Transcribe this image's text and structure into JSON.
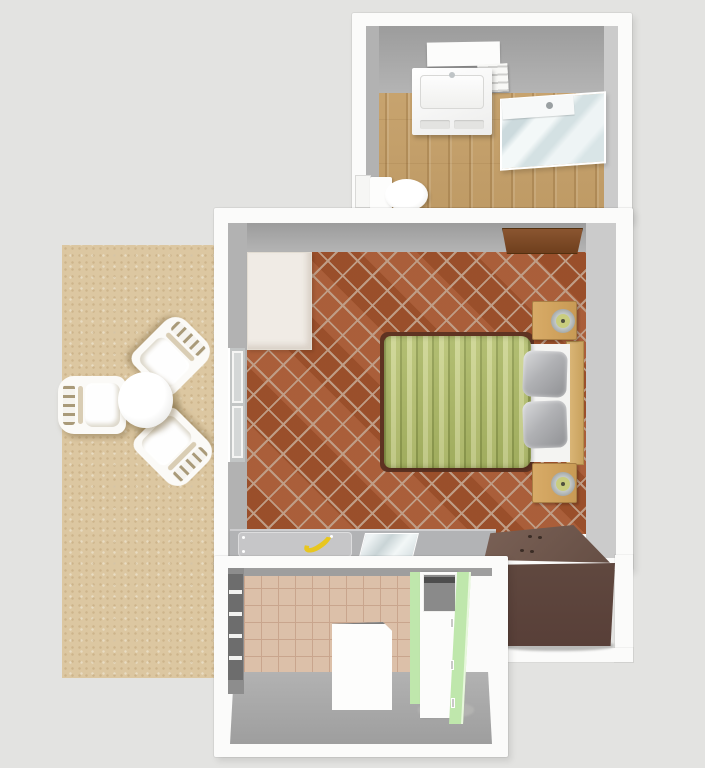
{
  "scene": {
    "view": "top-down 3D dollhouse render of a small apartment",
    "rooms": [
      {
        "id": "bathroom",
        "label": "Bathroom",
        "floor": "light wood planks"
      },
      {
        "id": "bedroom",
        "label": "Bedroom",
        "floor": "terracotta diamond tiles"
      },
      {
        "id": "kitchen",
        "label": "Kitchen",
        "floor": "beige ceramic tiles"
      },
      {
        "id": "patio",
        "label": "Patio",
        "floor": "sand"
      }
    ],
    "furniture": [
      {
        "room": "bathroom",
        "id": "mirror-shelf",
        "label": "Wall mirror shelf"
      },
      {
        "room": "bathroom",
        "id": "vanity-sink",
        "label": "Sink cabinet"
      },
      {
        "room": "bathroom",
        "id": "side-shelf",
        "label": "Towel shelf"
      },
      {
        "room": "bathroom",
        "id": "shower-cabin",
        "label": "Glass corner shower"
      },
      {
        "room": "bathroom",
        "id": "toilet",
        "label": "Toilet"
      },
      {
        "room": "bathroom",
        "id": "door-panel",
        "label": "Bathroom door"
      },
      {
        "room": "bedroom",
        "id": "entry-door",
        "label": "Open wooden door"
      },
      {
        "room": "bedroom",
        "id": "rug",
        "label": "Cream rug"
      },
      {
        "room": "bedroom",
        "id": "double-bed",
        "label": "Double bed with green striped duvet"
      },
      {
        "room": "bedroom",
        "id": "nightstand-north",
        "label": "Nightstand with lamp"
      },
      {
        "room": "bedroom",
        "id": "nightstand-south",
        "label": "Nightstand with lamp"
      },
      {
        "room": "bedroom",
        "id": "west-window",
        "label": "Window"
      },
      {
        "room": "bedroom",
        "id": "desk-counter",
        "label": "Desk counter"
      },
      {
        "room": "bedroom",
        "id": "paper-mat",
        "label": "Desk mat"
      },
      {
        "room": "bedroom",
        "id": "banana",
        "label": "Banana"
      },
      {
        "room": "bedroom",
        "id": "glass-pad",
        "label": "Glass pad"
      },
      {
        "room": "bedroom",
        "id": "dresser",
        "label": "Dark brown dresser"
      },
      {
        "room": "kitchen",
        "id": "window-blinds",
        "label": "Window with blinds"
      },
      {
        "room": "kitchen",
        "id": "cooktop-unit",
        "label": "Cooktop unit"
      },
      {
        "room": "kitchen",
        "id": "green-cabinets",
        "label": "Green cabinet column"
      },
      {
        "room": "kitchen",
        "id": "white-table",
        "label": "White table"
      },
      {
        "room": "patio",
        "id": "round-table",
        "label": "Round plastic table"
      },
      {
        "room": "patio",
        "id": "chair-west",
        "label": "Plastic garden chair"
      },
      {
        "room": "patio",
        "id": "chair-northeast",
        "label": "Plastic garden chair"
      },
      {
        "room": "patio",
        "id": "chair-southeast",
        "label": "Plastic garden chair"
      }
    ]
  },
  "colors": {
    "background": "#e3e3e1",
    "wall_white": "#fbfbfa",
    "wall_face_west": "#b2b2b2",
    "wall_face_east": "#cbcbcb",
    "bathroom_floor": "#c9a36b",
    "bedroom_floor": "#a5562f",
    "bedroom_floor_line": "#bf9d86",
    "patio_sand": "#dcc7a1",
    "kitchen_floor": "#dcc0a9",
    "kitchen_floor_line": "#c9a58d",
    "cabinet_green": "#bfe7ac",
    "counter_gray": "#b2b3b5",
    "banana_yellow": "#e8c61f",
    "duvet_green": "#aab763",
    "dresser_brown": "#5c453e",
    "door_brown": "#7b4a28"
  }
}
